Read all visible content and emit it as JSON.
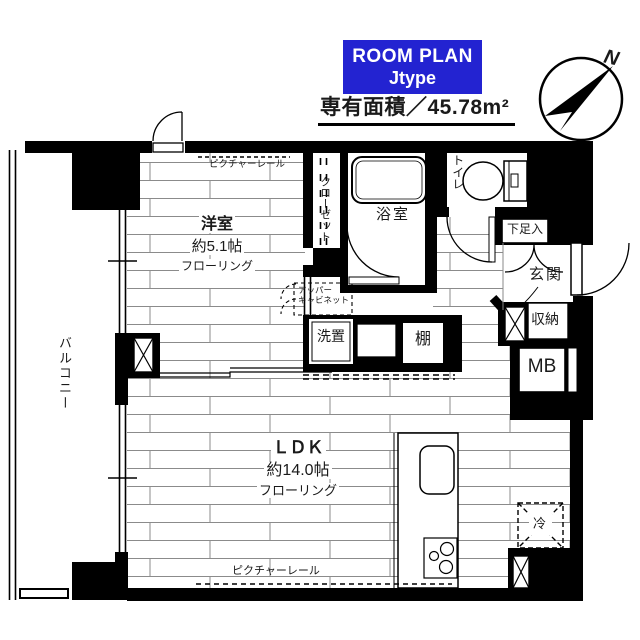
{
  "header": {
    "plan_box": {
      "line1": "ROOM PLAN",
      "line2": "Jtype"
    },
    "area_text": "専有面積／45.78m²",
    "compass_n": "N"
  },
  "colors": {
    "accent_blue": "#2323d1",
    "wall_black": "#000000",
    "plank_line": "#8b8b8b"
  },
  "rooms": {
    "western_room": {
      "name": "洋室",
      "size": "約5.1帖",
      "floor": "フローリング"
    },
    "ldk": {
      "name": "ＬＤＫ",
      "size": "約14.0帖",
      "floor": "フローリング"
    },
    "balcony": {
      "name": "バルコニー"
    },
    "bath": {
      "name": "浴室"
    },
    "toilet": {
      "name": "トイレ"
    },
    "closet": {
      "name": "クローゼット"
    },
    "entrance": {
      "name": "玄関"
    },
    "storage": {
      "name": "収納"
    },
    "meter_box": {
      "name": "MB"
    },
    "shoe_box": {
      "name": "下足入"
    },
    "laundry": {
      "name": "洗置"
    },
    "shelf": {
      "name": "棚"
    },
    "fridge": {
      "name": "冷"
    },
    "upper_cabinet": {
      "line1": "アッパー",
      "line2": "キャビネット"
    },
    "picture_rail_top": "ピクチャーレール",
    "picture_rail_bottom": "ピクチャーレール"
  }
}
